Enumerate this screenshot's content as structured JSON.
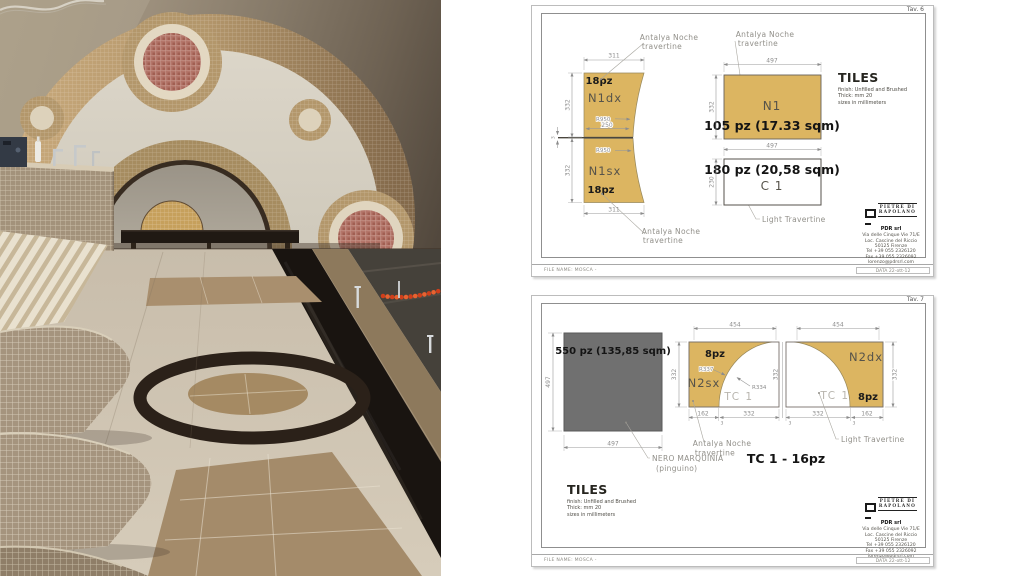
{
  "photo": {
    "wall": "#94887a",
    "arch_mosaic": "#b3976b",
    "accent_lane_rope": "#d2401c",
    "floor_cream": "#cdc2ae",
    "floor_dark_band": "#191410",
    "lounger_mosaic": "#a5947e"
  },
  "colors": {
    "gold": "#dcb561",
    "gray_block": "#707070",
    "dim_text": "#8c8c8c",
    "bold_text": "#141414",
    "tc_text": "#b8b5ae"
  },
  "footer": {
    "file_name": "FILE NAME: MOSCA -",
    "date": "DATA 22-ott-12"
  },
  "tiles_block": {
    "title": "TILES",
    "finish": "finish:  Unfilled and Brushed",
    "thick": "Thick: mm 20",
    "sizes": "sizes in millimeters"
  },
  "logo": {
    "brand_line1": "PIETRE DI",
    "brand_line2": "RAPOLANO",
    "company": "PDR srl",
    "address": [
      "Via delle Cinque Vie 71/E",
      "Loc. Cascine del Riccio",
      "50125 Firenze",
      "Tel +39 055 2326120",
      "Fax +39 055 2326092",
      "lorenzo@pdrsrl.com"
    ]
  },
  "sheet1": {
    "tav": "Tav. 6",
    "callout_top_left": [
      "Antalya Noche",
      "travertine"
    ],
    "callout_bottom_left": [
      "Antalya Noche",
      "travertine"
    ],
    "callout_n1": [
      "Antalya Noche",
      "travertine"
    ],
    "callout_c1": "Light Travertine",
    "left_shape": {
      "pz_top": "18pz",
      "name_top": "N1dx",
      "radius_top": "R950",
      "waist": "250",
      "radius_bottom": "R950",
      "name_bottom": "N1sx",
      "pz_bottom": "18pz",
      "dim_top": "311",
      "dim_bottom": "311",
      "dim_side_top": "332",
      "dim_side_bottom": "332",
      "dim_joint": "3"
    },
    "n1": {
      "name": "N1",
      "count": "105 pz (17.33 sqm)",
      "dim_width": "497",
      "dim_height": "332"
    },
    "c1": {
      "name": "C 1",
      "count": "180 pz (20,58 sqm)",
      "dim_width": "497",
      "dim_height": "230"
    }
  },
  "sheet2": {
    "tav": "Tav. 7",
    "nero": {
      "count": "550 pz (135,85 sqm)",
      "dim_width": "497",
      "dim_height": "497",
      "callout": [
        "NERO MARQUINIA",
        "(pinguino)"
      ]
    },
    "n2sx": {
      "pz": "8pz",
      "name": "N2sx",
      "radius_outer": "R337",
      "radius_inner": "R334",
      "tc": "TC 1",
      "dim_top": "454",
      "dim_side": "332"
    },
    "n2dx": {
      "pz": "8pz",
      "name": "N2dx",
      "tc": "TC 1",
      "dim_top": "454",
      "dim_side": "332"
    },
    "dim_mid": "332",
    "dims_bottom": [
      "162",
      "3",
      "332",
      "3",
      "332",
      "3",
      "162"
    ],
    "tc_total": "TC 1 - 16pz",
    "callout_antalya": [
      "Antalya Noche",
      "travertine"
    ],
    "callout_light": "Light Travertine"
  }
}
